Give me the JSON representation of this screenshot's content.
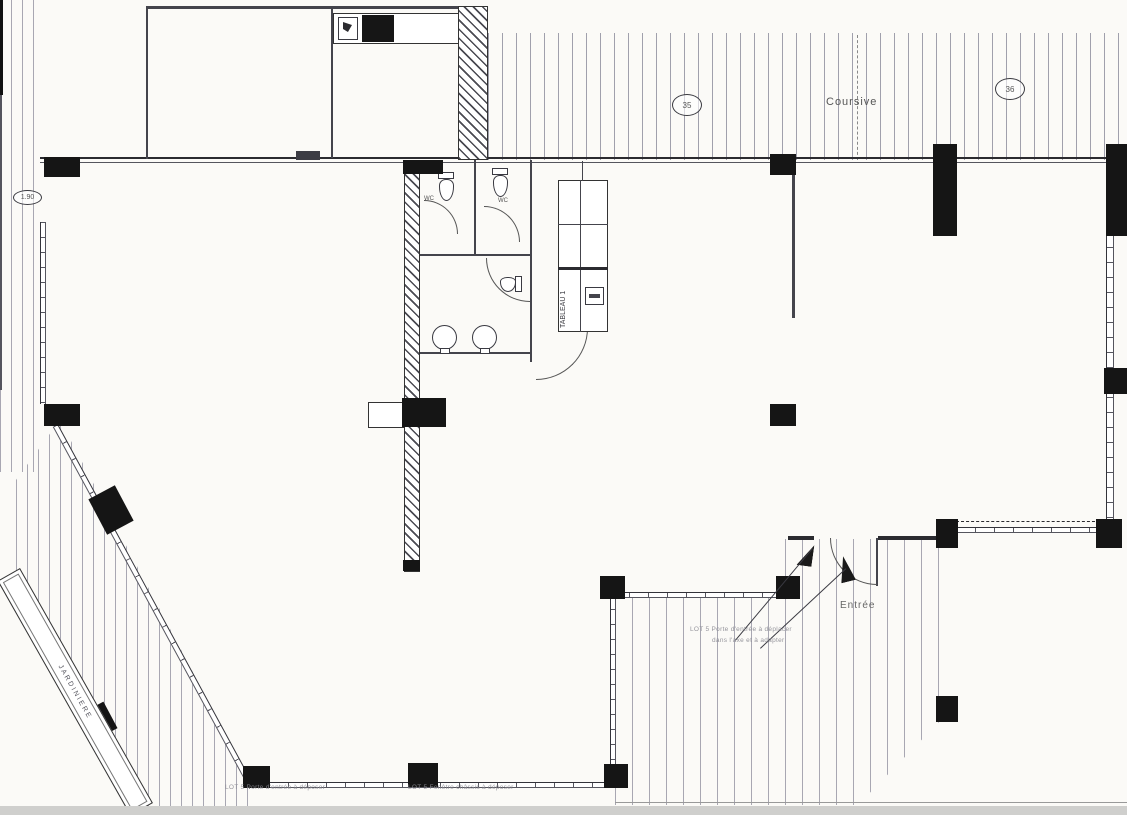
{
  "title": "Scanned architectural floor plan",
  "labels": {
    "coursive": "Coursive",
    "entree": "Entrée",
    "tableau": "TABLEAU 1",
    "jardiniere": "JARDINIERE",
    "wc_1": "WC",
    "wc_2": "WC",
    "grid_bubble_left": "35",
    "grid_bubble_right": "36",
    "dim_oval": "1.90"
  },
  "notes": {
    "entrance_line1": "LOT 5 Porte d'entrée à déplacer",
    "entrance_line2": "dans l'axe et à adapter",
    "bottom_left": "LOT 5 Porte d'entrée à déposer",
    "bottom_center": "LOT 5 Fenêtre châssis à déposer"
  },
  "colors": {
    "paper": "#fbfaf7",
    "ink": "#2b2b30",
    "column_fill": "#151515",
    "hatch_line": "#55556e",
    "annotation": "#8a8a92"
  }
}
